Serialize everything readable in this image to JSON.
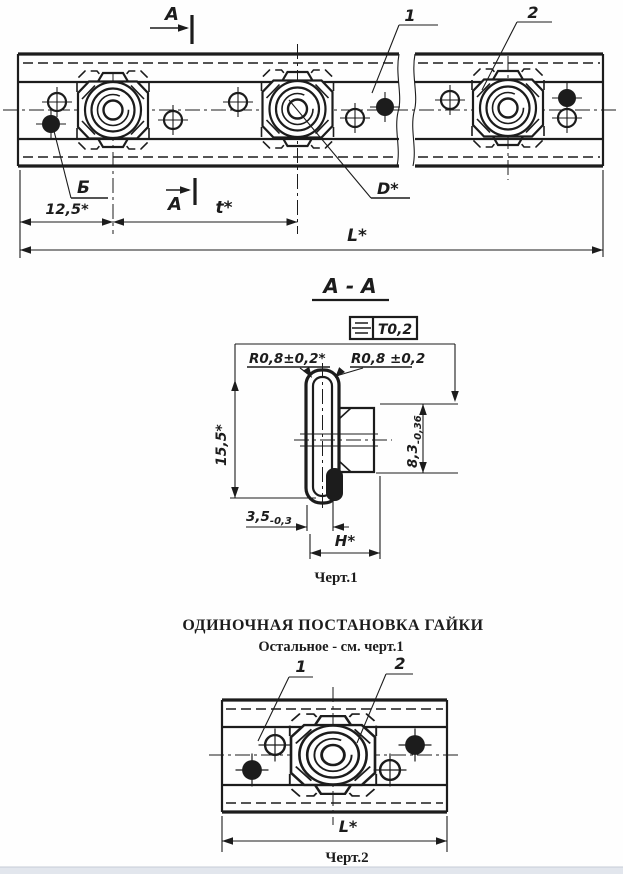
{
  "colors": {
    "ink": "#1c1c1c",
    "paper": "#fefefe",
    "footer_bar": "#e2e6ed"
  },
  "top_view": {
    "section_cut_label": "A",
    "callout_rail": "1",
    "callout_nut": "2",
    "hole_view_label": "Б",
    "dim_edge_offset": "12,5*",
    "dim_pitch": "t*",
    "dim_total_length": "L*",
    "thread_diameter_label": "D*"
  },
  "section_view": {
    "title": "A - A",
    "tolerance_value": "T0,2",
    "radius_label_left": "R0,8±0,2*",
    "radius_label_right": "R0,8 ±0,2",
    "dim_height": "15,5*",
    "dim_nut_height": {
      "value": "8,3",
      "tolerance": "-0,36"
    },
    "dim_lip": {
      "value": "3,5",
      "tolerance": "-0,3"
    },
    "dim_width_flats": "H*",
    "caption": "Черт.1"
  },
  "single_view": {
    "title": "ОДИНОЧНАЯ ПОСТАНОВКА ГАЙКИ",
    "subtitle": "Остальное - см. черт.1",
    "callout_rail": "1",
    "callout_nut": "2",
    "dim_total_length": "L*",
    "caption": "Черт.2"
  }
}
